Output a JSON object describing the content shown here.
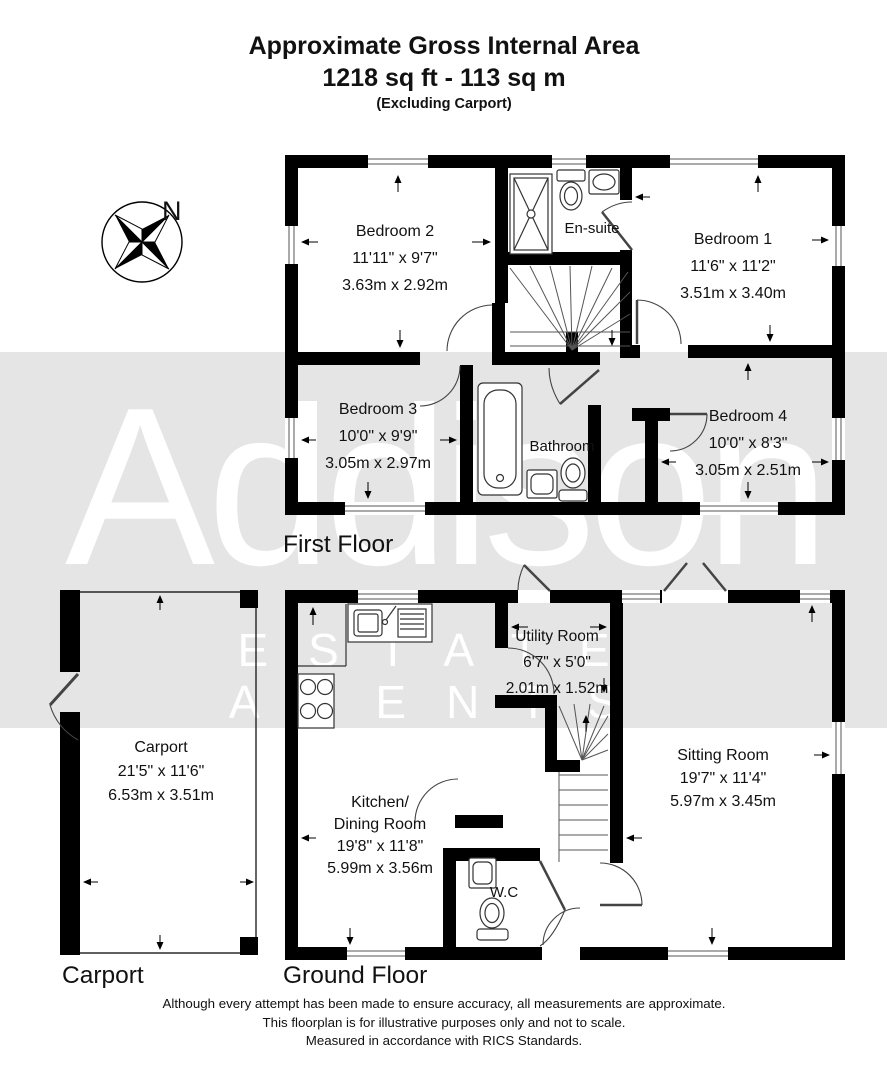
{
  "title": {
    "line1": "Approximate Gross Internal Area",
    "line2": "1218 sq ft - 113 sq m",
    "line3": "(Excluding Carport)"
  },
  "watermark": {
    "name": "Addison",
    "subtitle": "ESTATE AGENTS",
    "band_color": "#e5e5e5",
    "text_color": "#ffffff"
  },
  "compass": {
    "north_label": "N"
  },
  "floor_labels": {
    "first": "First Floor",
    "ground": "Ground Floor",
    "carport": "Carport"
  },
  "rooms": {
    "bedroom2": {
      "name": "Bedroom 2",
      "imperial": "11'11\" x 9'7\"",
      "metric": "3.63m x 2.92m"
    },
    "ensuite": {
      "name": "En-suite"
    },
    "bedroom1": {
      "name": "Bedroom 1",
      "imperial": "11'6\" x 11'2\"",
      "metric": "3.51m x 3.40m"
    },
    "bedroom3": {
      "name": "Bedroom 3",
      "imperial": "10'0\" x 9'9\"",
      "metric": "3.05m x 2.97m"
    },
    "bathroom": {
      "name": "Bathroom"
    },
    "bedroom4": {
      "name": "Bedroom 4",
      "imperial": "10'0\" x 8'3\"",
      "metric": "3.05m x 2.51m"
    },
    "carport": {
      "name": "Carport",
      "imperial": "21'5\" x 11'6\"",
      "metric": "6.53m x 3.51m"
    },
    "utility": {
      "name": "Utility Room",
      "imperial": "6'7\" x 5'0\"",
      "metric": "2.01m x 1.52m"
    },
    "kitchen": {
      "name": "Kitchen/",
      "name2": "Dining Room",
      "imperial": "19'8\" x 11'8\"",
      "metric": "5.99m x 3.56m"
    },
    "sitting": {
      "name": "Sitting Room",
      "imperial": "19'7\" x 11'4\"",
      "metric": "5.97m x 3.45m"
    },
    "wc": {
      "name": "W.C"
    }
  },
  "footer": {
    "line1": "Although every attempt has been made to ensure accuracy, all measurements are approximate.",
    "line2": "This floorplan is for illustrative purposes only and not to scale.",
    "line3": "Measured in accordance with RICS Standards."
  },
  "colors": {
    "walls": "#000000",
    "background": "#ffffff"
  }
}
